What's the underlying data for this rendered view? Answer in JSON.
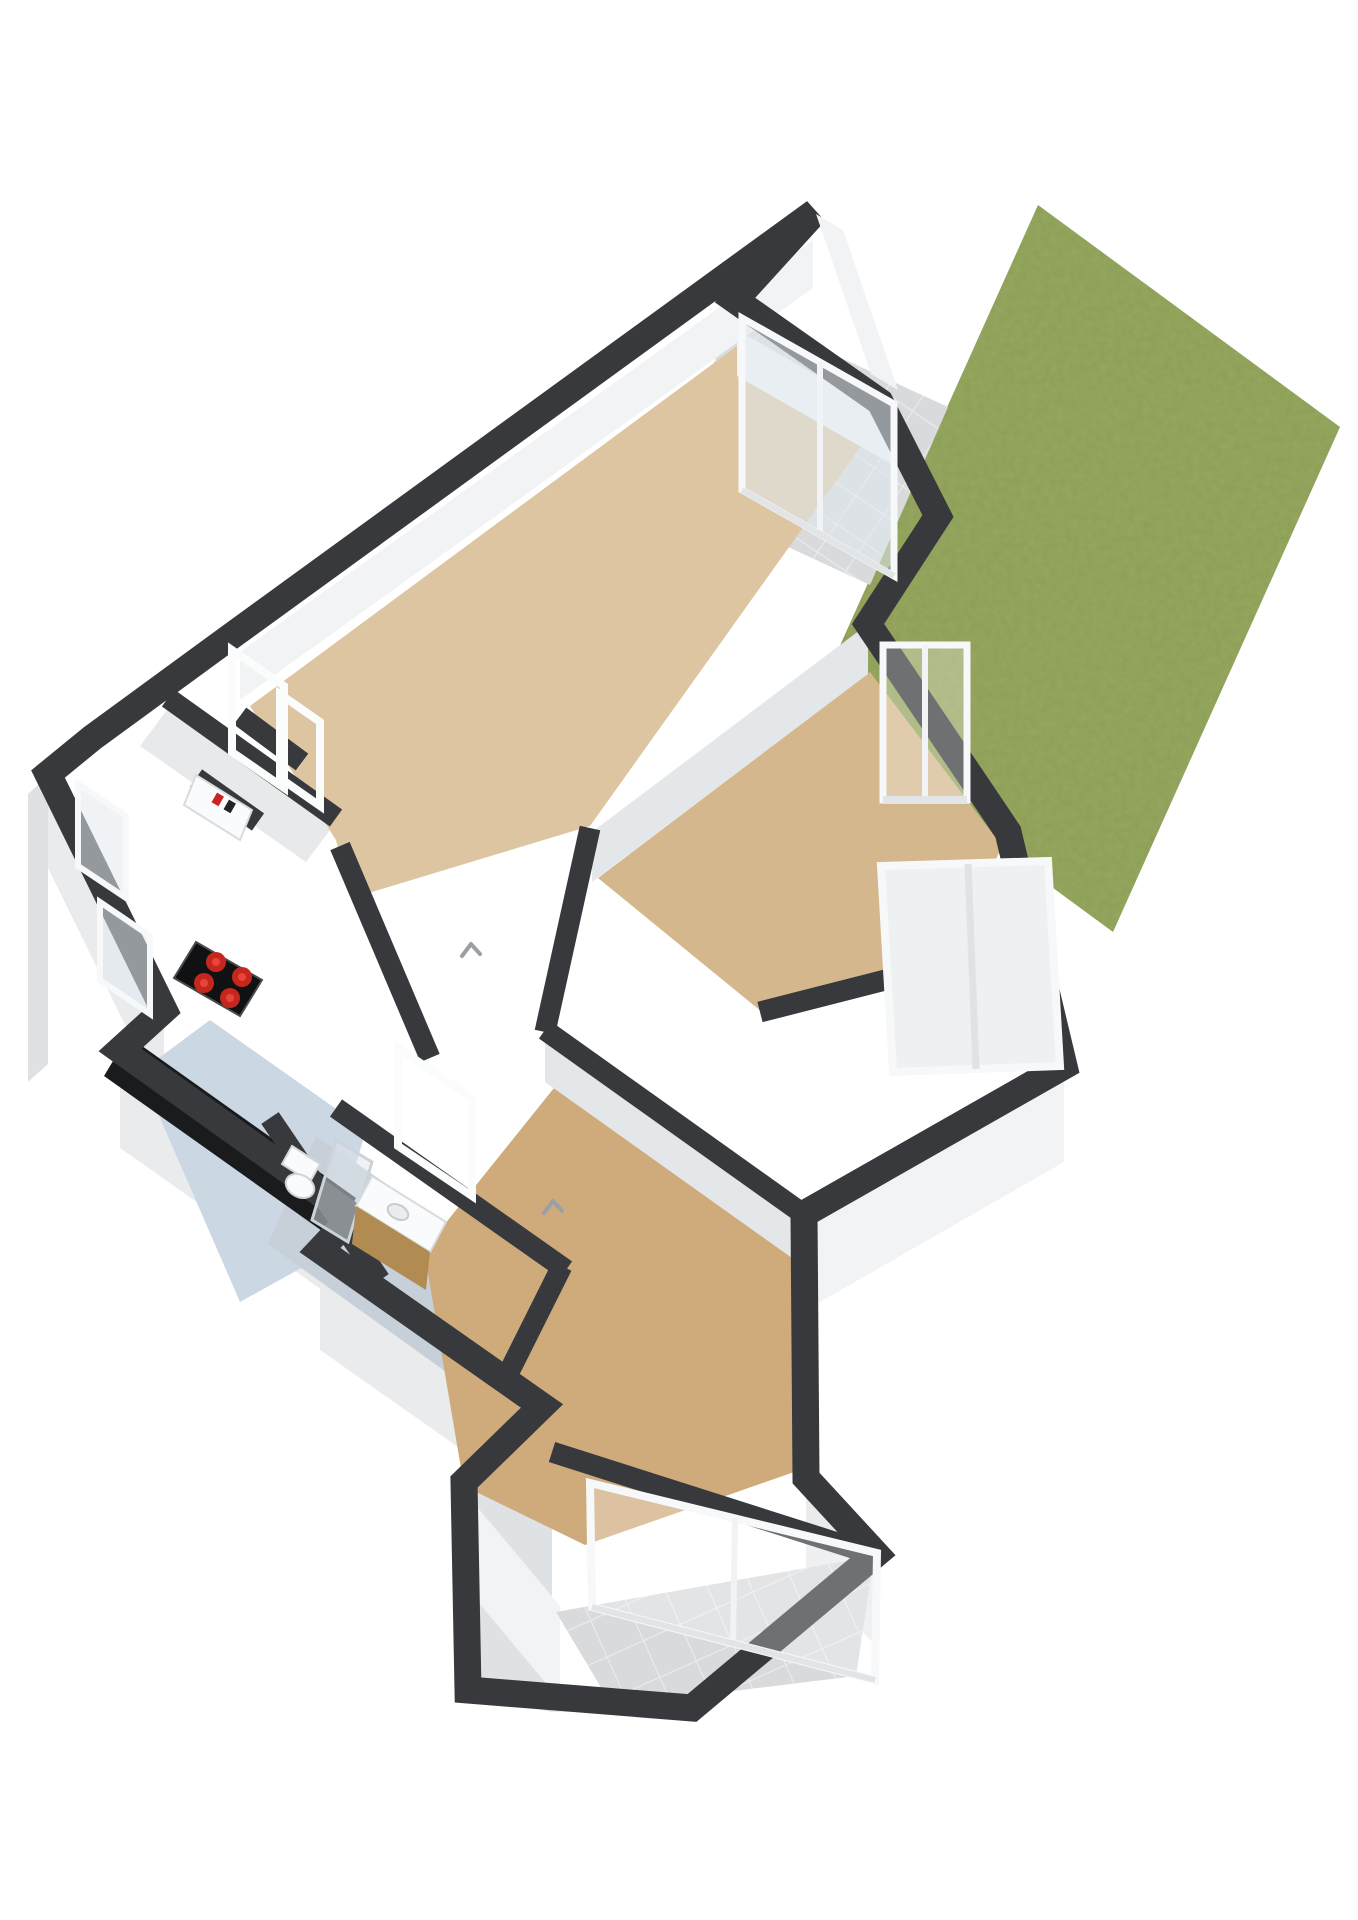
{
  "scene": {
    "type": "3d-floorplan-render",
    "description": "Isometric 3D floor plan of an apartment with garden, patio, balcony, kitchen, bathroom and two bedrooms",
    "text_labels": []
  },
  "colors": {
    "background": "#ffffff",
    "wall": "#37393c",
    "wallDark": "#2b2d2f",
    "faceLight": "#f2f3f5",
    "faceMid": "#e9ebed",
    "faceShadow": "#dfe2e4",
    "faceInnerShadow": "#e4e7e9",
    "floorLiving": "#dcc5a0",
    "floorBedroomMid": "#d5b78d",
    "floorBedroomBottom": "#cfab7c",
    "floorKitchen": "#ccd7e4",
    "floorBath": "#c7d0d8",
    "floorHall": "#e8e9ea",
    "garden": "#8d9f55",
    "tile": "#d8dadc",
    "tileLine": "#e9ebee",
    "counter": "#1a1b1d",
    "stove": "#101112",
    "burner": "#c5271e",
    "burnerInner": "#e8443a",
    "wood": "#b28b52",
    "glass": "rgba(226,233,238,0.55)",
    "glassClear": "rgba(255,255,255,0.28)",
    "frame": "#fbfcfc",
    "frameShade": "#c9cdd0",
    "chevron": "#9aa0a5",
    "meterRed": "#cc2222",
    "porcelain": "#fafbfc"
  },
  "rooms": [
    {
      "name": "living-room"
    },
    {
      "name": "hallway"
    },
    {
      "name": "kitchen"
    },
    {
      "name": "bathroom"
    },
    {
      "name": "bedroom-middle"
    },
    {
      "name": "bedroom-bottom"
    },
    {
      "name": "balcony"
    },
    {
      "name": "patio"
    },
    {
      "name": "garden"
    }
  ],
  "fixtures": [
    {
      "name": "cooktop-with-four-burners"
    },
    {
      "name": "kitchen-counter"
    },
    {
      "name": "toilet"
    },
    {
      "name": "shower-screen"
    },
    {
      "name": "vanity-with-sink"
    },
    {
      "name": "electric-meter-cabinet"
    },
    {
      "name": "sliding-glass-door"
    },
    {
      "name": "windows"
    }
  ]
}
